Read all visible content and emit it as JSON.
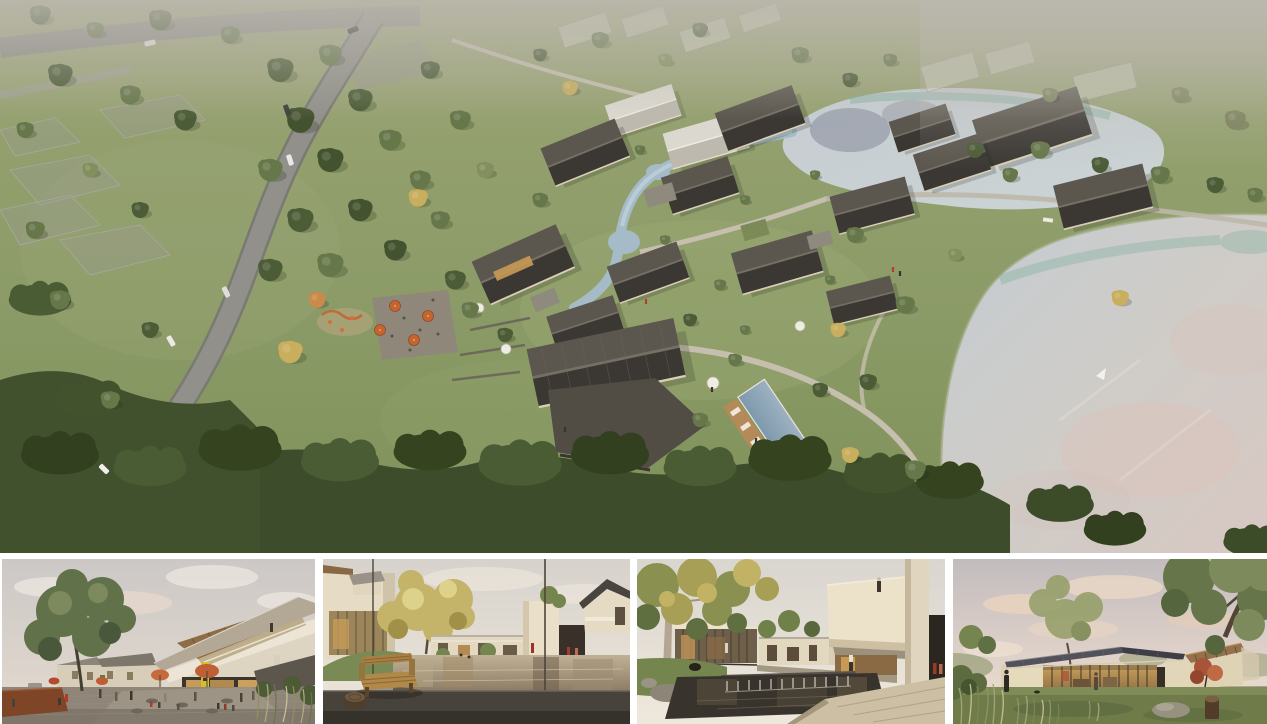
{
  "page": {
    "background": "#ffffff"
  },
  "collage": {
    "main_view": {
      "name": "aerial-masterplan-render",
      "label": "Aerial render of a lakeside village resort: curving road, dark-roofed houses around a stream and pool, two ponds, meadows and forest"
    },
    "thumbnails": [
      {
        "name": "plaza-cafe-view",
        "label": "Village plaza with cafe seating, umbrellas and winged-roof building"
      },
      {
        "name": "pond-bench-courtyard-view",
        "label": "Courtyard reflecting pond with wooden bench in foreground"
      },
      {
        "name": "waterfall-garden-view",
        "label": "Garden court with weir waterfall and cantilevered balcony volume"
      },
      {
        "name": "dusk-pavilion-view",
        "label": "Single-storey glass pavilion on a lawn at dusk"
      }
    ],
    "palette": {
      "canvas_bg": "#ffffff",
      "grass": "#8a9a66",
      "forest": "#46552f",
      "roof_dark": "#43413d",
      "wall_beige": "#ddd3bc",
      "lake_gray": "#c9cfd4",
      "lake_teal": "#85b2a2",
      "lake_pink": "#d9c4bc",
      "road_gray": "#8d8c86",
      "umbrella_orange": "#c4642f",
      "wood": "#8f6f4c",
      "dusk_sky": "#e8dcd2"
    }
  }
}
